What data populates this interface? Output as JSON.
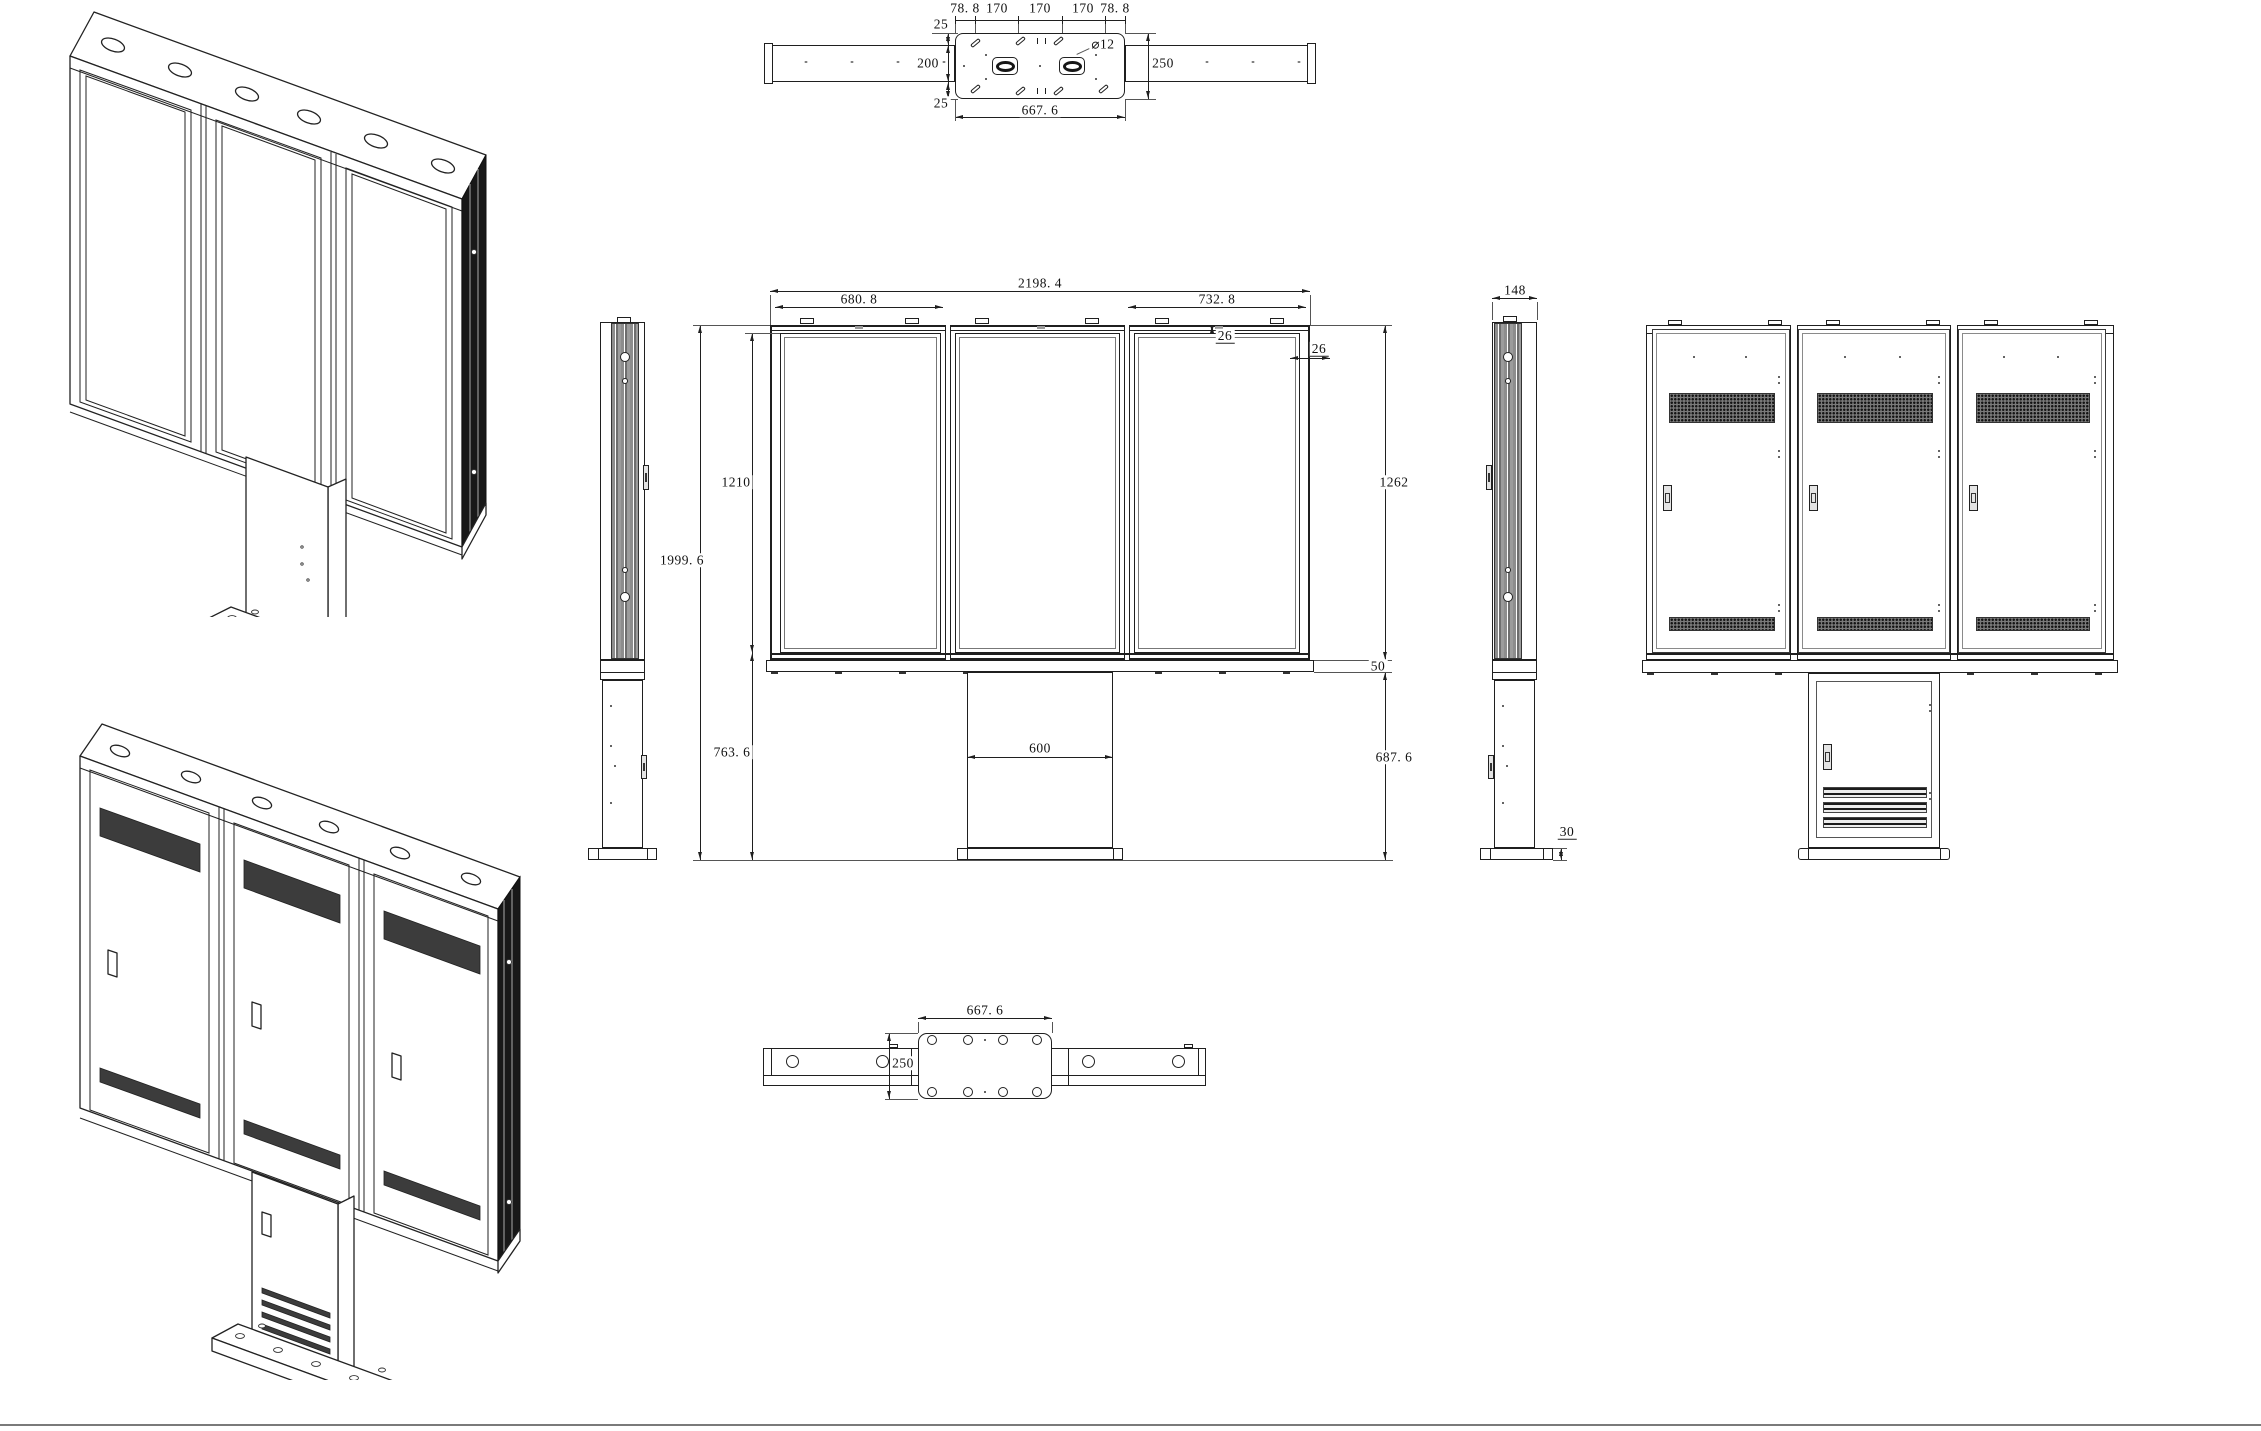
{
  "colors": {
    "line": "#1f1f1f",
    "fin_gray": "#8b8b8b",
    "vent_dark": "#3c3c3c"
  },
  "dims": {
    "top": {
      "m_top": "25",
      "spacings": [
        "78. 8",
        "170",
        "170",
        "170",
        "78. 8"
      ],
      "inner": "200",
      "m_bot": "25",
      "dia": "⌀12",
      "depth": "250",
      "width": "667. 6"
    },
    "front": {
      "overall_w": "2198. 4",
      "left_w": "680. 8",
      "right_w": "732. 8",
      "margin_top": "26",
      "margin_side": "26",
      "screen_h": "1210",
      "cab_h": "1262",
      "overall_h": "1999. 6",
      "lower_h": "763. 6",
      "col_w": "600",
      "ledge_h": "50",
      "stand_h": "687. 6"
    },
    "side": {
      "depth": "148",
      "base_h": "30"
    },
    "bottom": {
      "width": "667. 6",
      "depth": "250"
    }
  }
}
